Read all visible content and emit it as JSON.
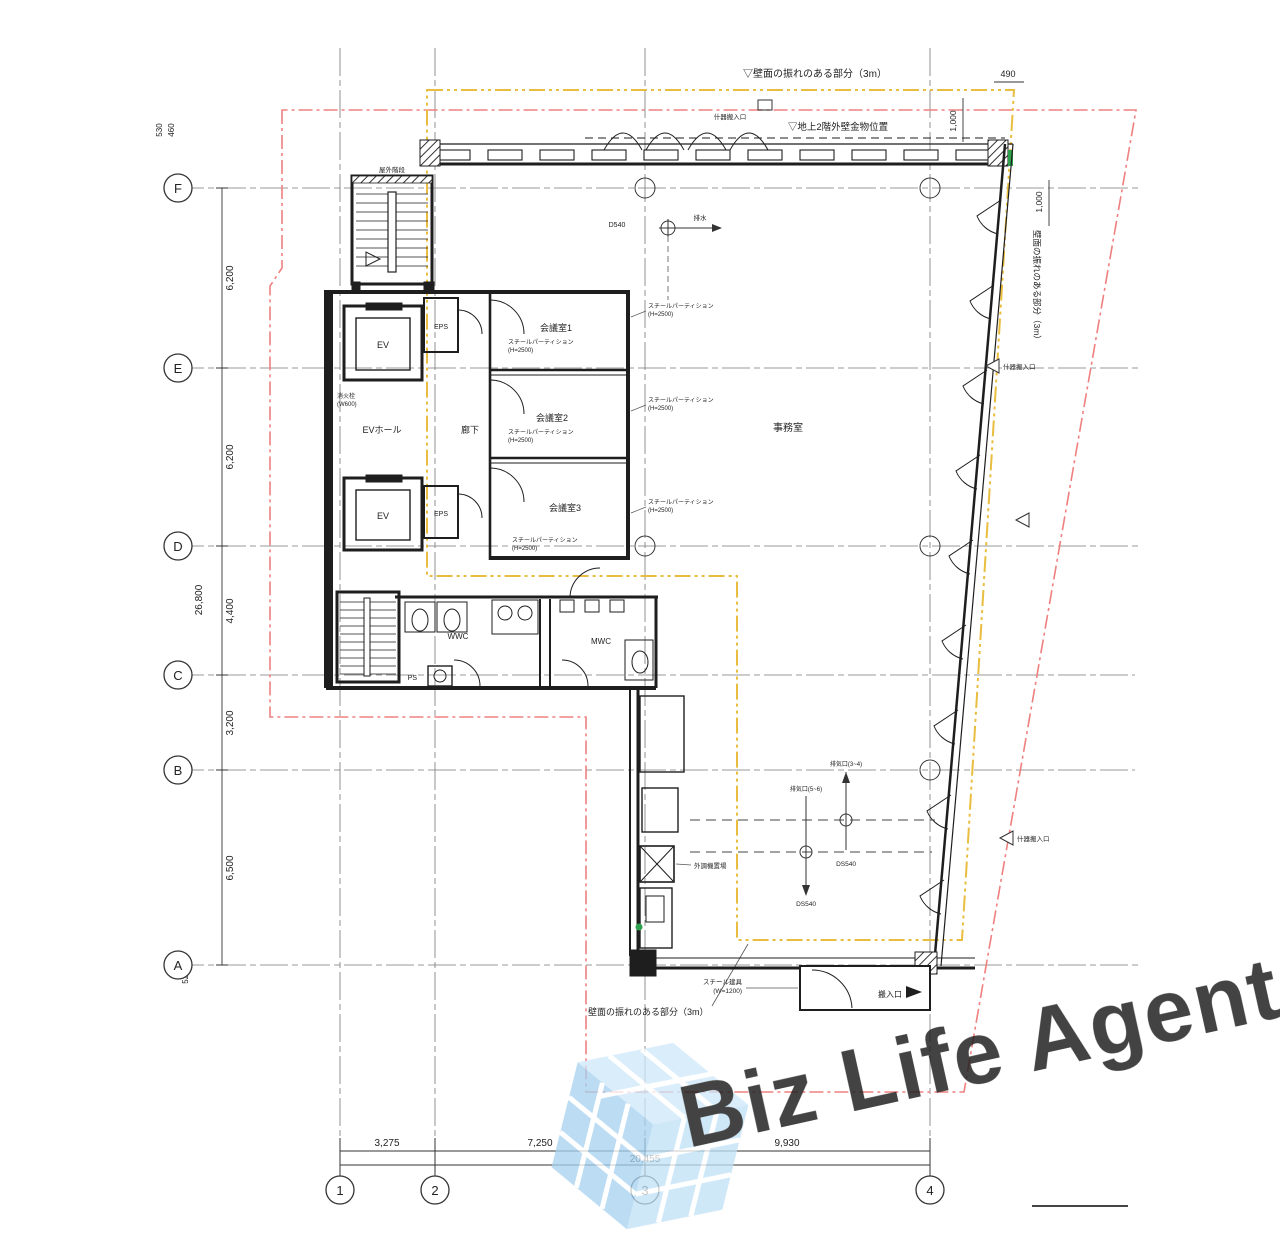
{
  "grid": {
    "rows": [
      "F",
      "E",
      "D",
      "C",
      "B",
      "A"
    ],
    "cols": [
      "1",
      "2",
      "3",
      "4"
    ]
  },
  "dimensions": {
    "left": {
      "top_offset_1": "530",
      "top_offset_2": "460",
      "overall": "26,800",
      "segments": [
        "6,200",
        "6,200",
        "4,400",
        "3,200",
        "6,500"
      ],
      "bottom_offset": "525"
    },
    "bottom": {
      "segments": [
        "3,275",
        "7,250",
        "9,930"
      ],
      "total": "20,455"
    },
    "top_right": {
      "d490": "490",
      "d1000a": "1,000",
      "d1000b": "1,000"
    }
  },
  "rooms": {
    "ev": "EV",
    "ev_hall": "EVホール",
    "eps": "EPS",
    "corridor": "廊下",
    "meeting1": "会議室1",
    "meeting2": "会議室2",
    "meeting3": "会議室3",
    "office": "事務室",
    "wwc": "WWC",
    "mwc": "MWC",
    "ps": "PS"
  },
  "annotations": {
    "setback_yellow_top": "▽壁面の振れのある部分（3m）",
    "setback_yellow_bottom": "壁面の振れのある部分（3m）",
    "setback_yellow_right": "壁面の振れのある部分（3m）",
    "upper_wall_note": "▽地上2階外壁金物位置",
    "carry_in": "搬入口",
    "fixture_entrance": "什器搬入口",
    "outdoor_stair": "屋外階段",
    "partition_line1": "スチールパーティション",
    "partition_line2": "(H=2500)",
    "steel_door_line1": "スチール建具",
    "steel_door_line2": "(W=1200)",
    "hydrant_line1": "消火栓",
    "hydrant_line2": "(W600)",
    "ahu": "外調機置場",
    "d540": "D540",
    "ds540": "DS540",
    "drain": "排水",
    "vent_a": "排気口(5~6)",
    "vent_b": "排気口(3~4)"
  },
  "watermark": {
    "text": "Biz Life Agent"
  },
  "colors": {
    "boundary_red": "#ef8080",
    "offset_yellow": "#e9bd3f",
    "line_black": "#1e1e1e",
    "accent_green": "#2fa04c",
    "watermark_gray": "#9a9a9a",
    "logo_blue": "#b9dcf5"
  }
}
